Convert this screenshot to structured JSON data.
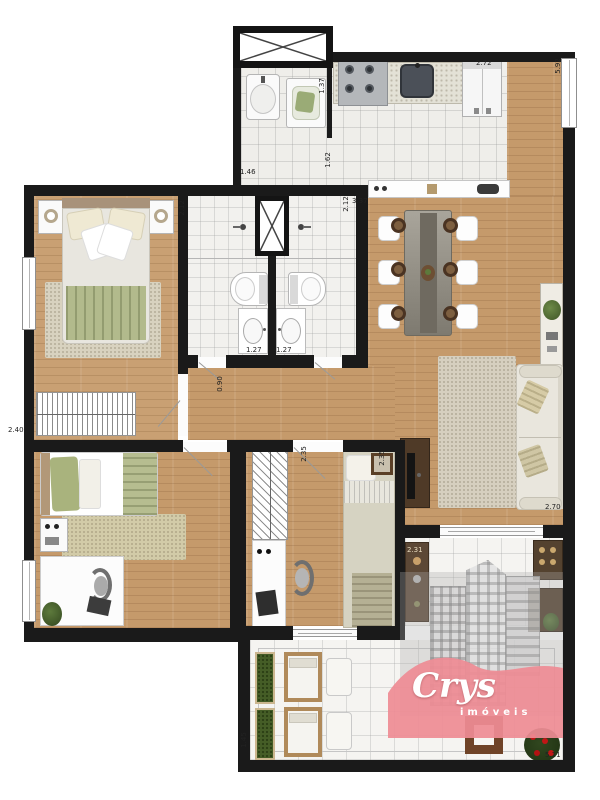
{
  "plan": {
    "dims": [
      {
        "id": "fridge-width",
        "text": "2.72"
      },
      {
        "id": "right-wall-height",
        "text": "5.92"
      },
      {
        "id": "laundry-width",
        "text": "1.37"
      },
      {
        "id": "kitchen-depth",
        "text": "1.62"
      },
      {
        "id": "laundry-length",
        "text": "1.46"
      },
      {
        "id": "dining-width",
        "text": "3.37"
      },
      {
        "id": "bath-left-depth",
        "text": "2.12"
      },
      {
        "id": "bath-right-depth",
        "text": "2.12"
      },
      {
        "id": "bath-left-width",
        "text": "1.27"
      },
      {
        "id": "bath-right-width",
        "text": "1.27"
      },
      {
        "id": "master-wardrobe-width",
        "text": "2.40"
      },
      {
        "id": "hallway-width",
        "text": "0.90"
      },
      {
        "id": "bedroom3-depth-a",
        "text": "2.35"
      },
      {
        "id": "bedroom3-depth-b",
        "text": "2.35"
      },
      {
        "id": "living-width",
        "text": "2.70"
      },
      {
        "id": "terrace-bench-width",
        "text": "2.31"
      },
      {
        "id": "terrace-depth",
        "text": "1.45"
      },
      {
        "id": "terrace-width",
        "text": "5.11"
      }
    ],
    "logo": {
      "name": "Crys",
      "tagline": "imóveis"
    },
    "colors": {
      "wall": "#1a1a1a",
      "wood_floor": "#c59a6b",
      "tile_floor": "#efeeea",
      "sage_green": "#a9b37d",
      "planter_green": "#455d26",
      "bench_wood": "#5c4836",
      "logo_pink": "#ee8c95",
      "logo_text": "#ffffff",
      "flower_red": "#c01616"
    }
  }
}
